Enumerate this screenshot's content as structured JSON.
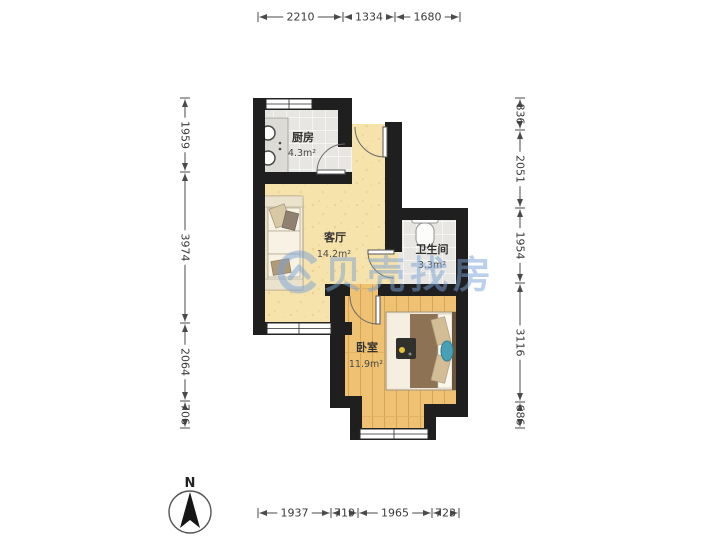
{
  "page": {
    "background": "#ffffff"
  },
  "compass": {
    "label": "N"
  },
  "watermark": {
    "text": "贝壳找房",
    "color": "#7aa3d8"
  },
  "rooms": {
    "kitchen": {
      "name": "厨房",
      "area": "4.3m²"
    },
    "living": {
      "name": "客厅",
      "area": "14.2m²"
    },
    "bathroom": {
      "name": "卫生间",
      "area": "3.3m²"
    },
    "bedroom": {
      "name": "卧室",
      "area": "11.9m²"
    }
  },
  "dimensions": {
    "top": {
      "orientation": "h",
      "line": 17,
      "ticks": [
        258,
        343,
        395,
        460
      ],
      "values": [
        "2210",
        "1334",
        "1680"
      ]
    },
    "bottom": {
      "orientation": "h",
      "line": 513,
      "ticks": [
        258,
        331,
        358,
        432,
        459
      ],
      "values": [
        "1937",
        "719",
        "1965",
        "723"
      ]
    },
    "left": {
      "orientation": "v",
      "line": 185,
      "ticks": [
        98,
        172,
        323,
        401,
        428
      ],
      "values": [
        "1959",
        "3974",
        "2064",
        "706"
      ]
    },
    "right": {
      "orientation": "v",
      "line": 520,
      "ticks": [
        98,
        130,
        208,
        283,
        402,
        428
      ],
      "values": [
        "836",
        "2051",
        "1954",
        "3116",
        "686"
      ]
    }
  },
  "colors": {
    "wall": "#1f1f1f",
    "tile_floor": "#e8e6e2",
    "tan_floor": "#f6e2ab",
    "wood_floor": "#efc173",
    "watermark_blue": "#7aa3d8",
    "dim_text": "#3a3a3a"
  }
}
